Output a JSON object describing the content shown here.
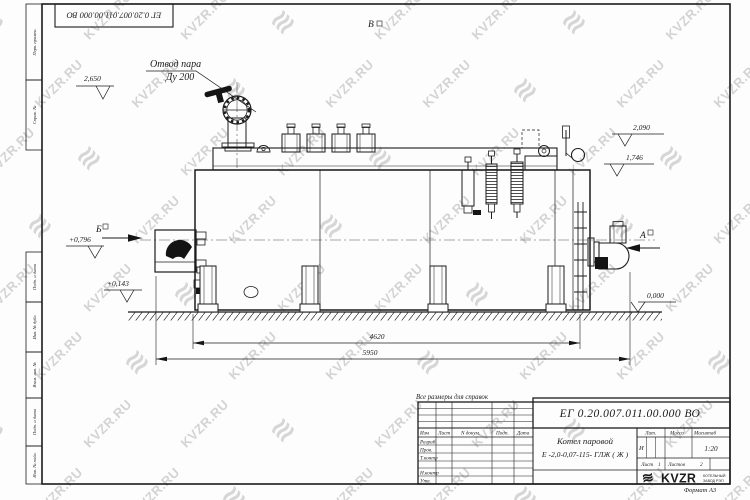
{
  "watermark": {
    "text": "KVZR.RU",
    "icon_glyph": "≋"
  },
  "corner_stamp": {
    "designation": "ЕГ 0.20.007.011.00.000  ВО"
  },
  "margin_columns": {
    "perv_primen": "Перв. примен.",
    "sprav_no": "Справ. №",
    "podp_data_1": "Подп. и дата",
    "inv_no_dubl": "Инв. № дубл.",
    "vzam_inv_no": "Взам. инв. №",
    "podp_data_2": "Подп. и дата",
    "inv_no_podl": "Инв. № подл."
  },
  "drawing": {
    "note": "Все размеры для справок",
    "labels": {
      "steam_line1": "Отвод пара",
      "steam_line2": "Ду 200",
      "view_b": "Б",
      "view_a": "А",
      "view_v": "В"
    },
    "elevations": {
      "e2650": "2,650",
      "e0796": "+0,796",
      "e0143": "+0,143",
      "e2090": "2,090",
      "e1746": "1,746",
      "e0000": "0,000"
    },
    "dimensions": {
      "d4620": "4620",
      "d5950": "5950"
    }
  },
  "title_block": {
    "designation": "ЕГ 0.20.007.011.00.000  ВО",
    "name_line1": "Котел паровой",
    "name_line2": "Е -2,0-0,07-115- ГЛЖ ( Ж )",
    "header": {
      "izm": "Изм",
      "list": "Лист",
      "n_dokum": "N докум.",
      "podp": "Подп.",
      "data": "Дата"
    },
    "rows": {
      "razrab": "Разраб.",
      "prov": "Пров.",
      "t_kontr": "Т.контр",
      "n_kontr": "Н.контр",
      "utv": "Утв."
    },
    "lit_header": "Лит.",
    "massa_header": "Масса",
    "masshtab_header": "Масштаб",
    "lit_value": "И",
    "masshtab_value": "1:20",
    "list_label": "Лист",
    "list_value": "1",
    "listov_label": "Листов",
    "listov_value": "2",
    "logo": {
      "name": "KVZR",
      "sub1": "КОТЕЛЬНЫЙ",
      "sub2": "ЗАВОД РЭП"
    },
    "format_note": "Формат А3"
  }
}
